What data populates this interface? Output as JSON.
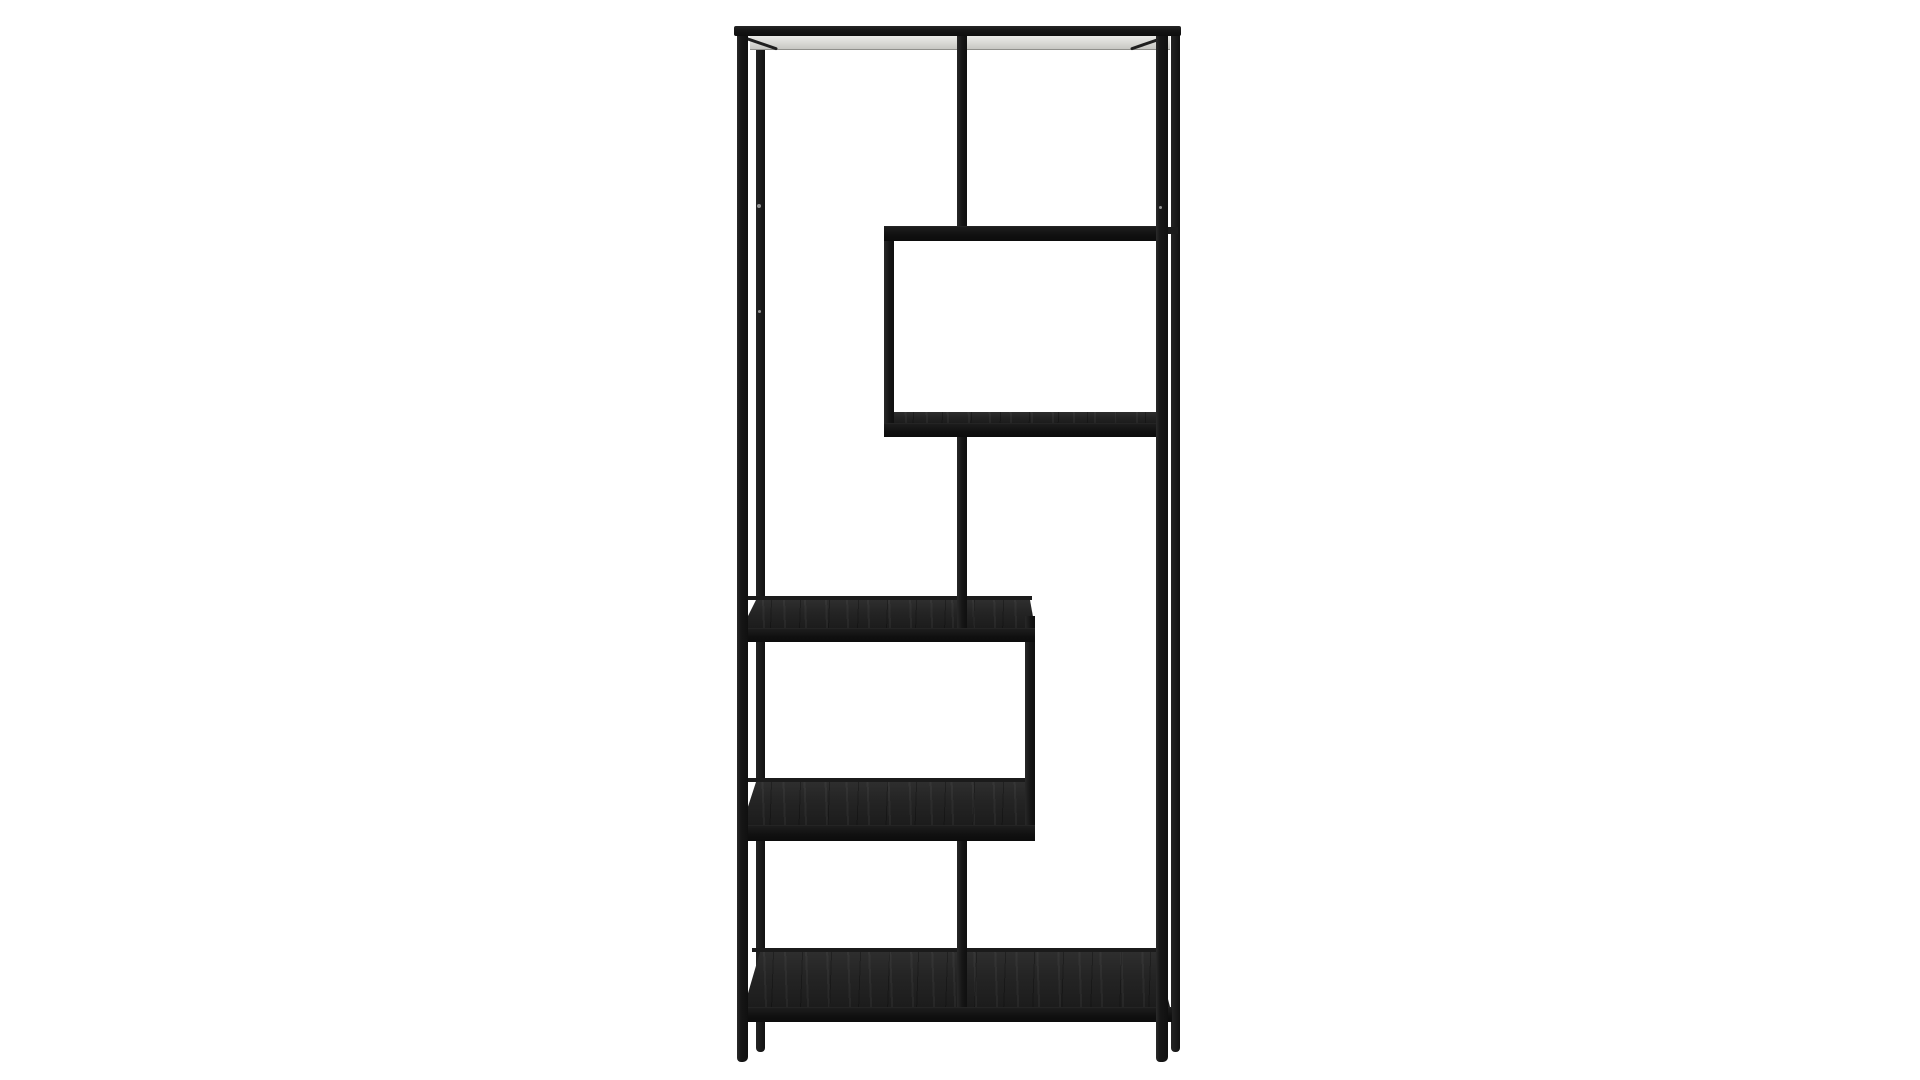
{
  "scene": {
    "type": "product-photo",
    "description": "Tall black metal asymmetric open bookcase with five staggered black-ash shelves on a seamless white studio background",
    "background": "#ffffff"
  },
  "colors": {
    "bg": "#ffffff",
    "metal": "#1b1b1b",
    "metalDark": "#0f0f0f",
    "wood": "#242424",
    "woodEdge": "#111111",
    "topPanel": "#d9d9d5",
    "screwDot": "#949494"
  },
  "bookcase": {
    "canvas": {
      "width": 1920,
      "height": 1080
    },
    "parts": [
      {
        "name": "back-post-left",
        "kind": "backpost",
        "x": 756,
        "y": 33,
        "w": 9,
        "h": 1019
      },
      {
        "name": "back-post-right",
        "kind": "backpost",
        "x": 1171,
        "y": 33,
        "w": 9,
        "h": 1019
      },
      {
        "name": "shelf-a-back-rail",
        "kind": "thin",
        "x": 1164,
        "y": 227,
        "w": 14,
        "h": 7
      },
      {
        "name": "top-panel-underside",
        "kind": "panel",
        "x": 750,
        "y": 36,
        "w": 420,
        "h": 13
      },
      {
        "name": "top-corner-brace-left",
        "kind": "brace",
        "x": 741,
        "y": 35,
        "w": 39,
        "h": 3,
        "rotate": 19,
        "origin": "0% 0%"
      },
      {
        "name": "top-corner-brace-right",
        "kind": "brace",
        "x": 1128,
        "y": 35,
        "w": 39,
        "h": 3,
        "rotate": -19,
        "origin": "100% 0%"
      },
      {
        "name": "shelf-b-surface",
        "kind": "wood-thin",
        "x": 884,
        "y": 412,
        "w": 284,
        "h": 11
      },
      {
        "name": "shelf-c-back-rail",
        "kind": "thin",
        "x": 748,
        "y": 596,
        "w": 284,
        "h": 4
      },
      {
        "name": "shelf-c-surface",
        "kind": "wood",
        "x": 742,
        "y": 600,
        "w": 293,
        "h": 28
      },
      {
        "name": "shelf-d-back-rail",
        "kind": "thin",
        "x": 748,
        "y": 778,
        "w": 284,
        "h": 4
      },
      {
        "name": "shelf-d-surface",
        "kind": "wood",
        "x": 742,
        "y": 782,
        "w": 293,
        "h": 43
      },
      {
        "name": "shelf-e-back-rail",
        "kind": "thin",
        "x": 752,
        "y": 948,
        "w": 414,
        "h": 4
      },
      {
        "name": "shelf-e-surface",
        "kind": "wood-full",
        "x": 744,
        "y": 952,
        "w": 426,
        "h": 55
      },
      {
        "name": "top-center-divider",
        "kind": "vert",
        "x": 957,
        "y": 30,
        "w": 10,
        "h": 202
      },
      {
        "name": "box-left-upright",
        "kind": "vert",
        "x": 884,
        "y": 228,
        "w": 10,
        "h": 202
      },
      {
        "name": "mid-center-divider",
        "kind": "vert",
        "x": 957,
        "y": 430,
        "w": 10,
        "h": 206
      },
      {
        "name": "mid-right-upright",
        "kind": "vert",
        "x": 1025,
        "y": 616,
        "w": 10,
        "h": 220
      },
      {
        "name": "lower-center-divider",
        "kind": "vert",
        "x": 957,
        "y": 838,
        "w": 10,
        "h": 176
      },
      {
        "name": "shelf-a-board",
        "kind": "edge",
        "x": 884,
        "y": 226,
        "w": 284,
        "h": 14
      },
      {
        "name": "shelf-b-front-edge",
        "kind": "edge",
        "x": 884,
        "y": 423,
        "w": 284,
        "h": 13
      },
      {
        "name": "shelf-c-front-edge",
        "kind": "edge",
        "x": 740,
        "y": 628,
        "w": 295,
        "h": 13
      },
      {
        "name": "shelf-d-front-edge",
        "kind": "edge",
        "x": 740,
        "y": 825,
        "w": 295,
        "h": 15
      },
      {
        "name": "shelf-e-front-edge",
        "kind": "edge",
        "x": 740,
        "y": 1007,
        "w": 432,
        "h": 14
      },
      {
        "name": "front-post-left",
        "kind": "post",
        "x": 737,
        "y": 26,
        "w": 11,
        "h": 1036
      },
      {
        "name": "front-post-right",
        "kind": "post",
        "x": 1156,
        "y": 26,
        "w": 12,
        "h": 1036
      },
      {
        "name": "top-frame-bar",
        "kind": "bar",
        "x": 734,
        "y": 26,
        "w": 447,
        "h": 10
      },
      {
        "name": "screw-dot-left-upper",
        "kind": "dot",
        "x": 757,
        "y": 204,
        "w": 4,
        "h": 4
      },
      {
        "name": "screw-dot-left-lower",
        "kind": "dot",
        "x": 758,
        "y": 310,
        "w": 3,
        "h": 3
      },
      {
        "name": "screw-dot-right",
        "kind": "dot",
        "x": 1159,
        "y": 206,
        "w": 3,
        "h": 3
      }
    ]
  }
}
